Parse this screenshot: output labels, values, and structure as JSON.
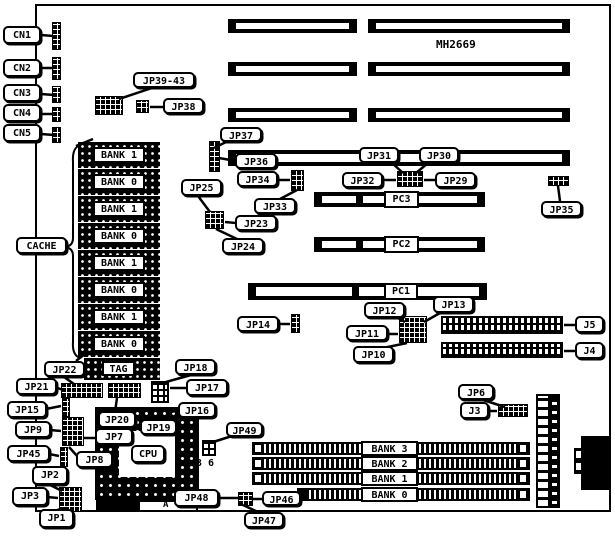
{
  "board": {
    "chipset_label": "MH2669",
    "a_mark": "A"
  },
  "callouts": {
    "cn1": "CN1",
    "cn2": "CN2",
    "cn3": "CN3",
    "cn4": "CN4",
    "cn5": "CN5",
    "jp39_43": "JP39-43",
    "jp38": "JP38",
    "jp37": "JP37",
    "jp36": "JP36",
    "jp31": "JP31",
    "jp30": "JP30",
    "jp32": "JP32",
    "jp29": "JP29",
    "jp34": "JP34",
    "jp33": "JP33",
    "jp25": "JP25",
    "jp23": "JP23",
    "jp24": "JP24",
    "jp35": "JP35",
    "jp14": "JP14",
    "jp12": "JP12",
    "jp13": "JP13",
    "jp11": "JP11",
    "jp10": "JP10",
    "j5": "J5",
    "j4": "J4",
    "jp6": "JP6",
    "j3": "J3",
    "cache": "CACHE",
    "jp22": "JP22",
    "jp21": "JP21",
    "jp18": "JP18",
    "jp17": "JP17",
    "jp15": "JP15",
    "jp20": "JP20",
    "jp16": "JP16",
    "jp19": "JP19",
    "jp9": "JP9",
    "jp7": "JP7",
    "jp45": "JP45",
    "jp8": "JP8",
    "jp2": "JP2",
    "jp3": "JP3",
    "jp1": "JP1",
    "jp49": "JP49",
    "jp48": "JP48",
    "jp46": "JP46",
    "jp47": "JP47",
    "cpu": "CPU"
  },
  "slots": {
    "pc1": "PC1",
    "pc2": "PC2",
    "pc3": "PC3"
  },
  "cache_chips": [
    "BANK 1",
    "BANK 0",
    "BANK 1",
    "BANK 0",
    "BANK 1",
    "BANK 0",
    "BANK 1",
    "BANK 0"
  ],
  "tag_label": "TAG",
  "simm_banks": [
    "BANK 3",
    "BANK 2",
    "BANK 1",
    "BANK 0"
  ],
  "pin_labels": {
    "pin3": "3",
    "pin6": "6"
  },
  "colors": {
    "ink": "#000000",
    "paper": "#ffffff"
  }
}
